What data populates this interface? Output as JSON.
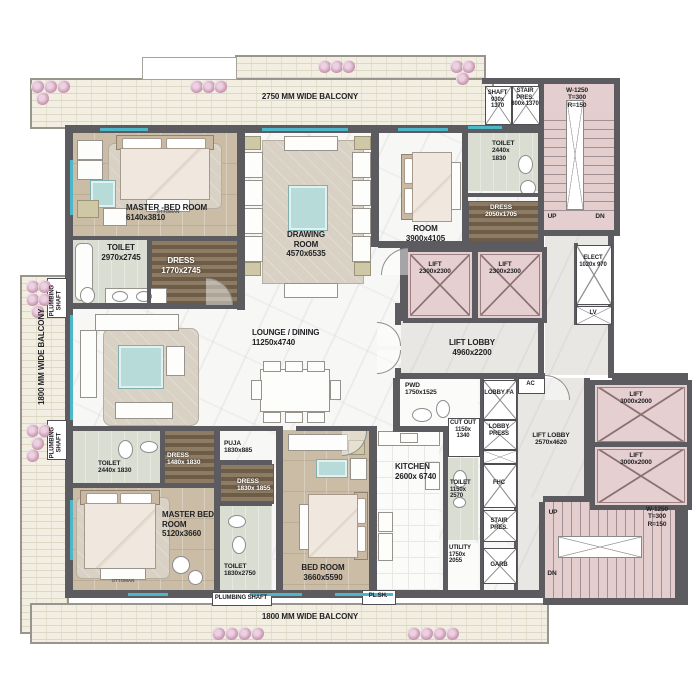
{
  "balcony": {
    "top": "2750 MM WIDE BALCONY",
    "left": "1800 MM WIDE BALCONY",
    "bottom": "1800 MM WIDE BALCONY"
  },
  "rooms": {
    "master_bed_1": {
      "name": "MASTER -BED ROOM",
      "dims": "6140x3810"
    },
    "toilet_1": {
      "name": "TOILET",
      "dims": "2970x2745"
    },
    "dress_1": {
      "name": "DRESS",
      "dims": "1770x2745"
    },
    "drawing": {
      "name": "DRAWING ROOM",
      "dims": "4570x6535"
    },
    "room": {
      "name": "ROOM",
      "dims": "3900x4105"
    },
    "toilet_2": {
      "name": "TOILET",
      "dims": "2440x 1830"
    },
    "dress_2": {
      "name": "DRESS",
      "dims": "2050x1705"
    },
    "lounge": {
      "name": "LOUNGE / DINING",
      "dims": "11250x4740"
    },
    "lift_lobby_1": {
      "name": "LIFT LOBBY",
      "dims": "4960x2200"
    },
    "lift_lobby_2": {
      "name": "LIFT LOBBY",
      "dims": "2570x4620"
    },
    "pwd": {
      "name": "PWD",
      "dims": "1750x1525"
    },
    "cut_out": {
      "name": "CUT OUT",
      "dims": "1150x 1340"
    },
    "toilet_5": {
      "name": "TOILET",
      "dims": "1150x 2570"
    },
    "utility": {
      "name": "UTILITY",
      "dims": "1750x 2055"
    },
    "kitchen": {
      "name": "KITCHEN",
      "dims": "2600x 6740"
    },
    "bed_room": {
      "name": "BED ROOM",
      "dims": "3660x5590"
    },
    "master_bed_2": {
      "name": "MASTER BED ROOM",
      "dims": "5120x3660"
    },
    "toilet_3": {
      "name": "TOILET",
      "dims": "2440x 1830"
    },
    "dress_3": {
      "name": "DRESS",
      "dims": "1480x 1830"
    },
    "puja": {
      "name": "PUJA",
      "dims": "1830x885"
    },
    "dress_4": {
      "name": "DRESS",
      "dims": "1830x 1855"
    },
    "toilet_4": {
      "name": "TOILET",
      "dims": "1830x2750"
    }
  },
  "service": {
    "shaft": {
      "name": "SHAFT",
      "dims": "930x 1370"
    },
    "stair_pres_1": {
      "name": "STAIR PRES.",
      "dims": "800x 1370"
    },
    "elect": {
      "name": "ELECT",
      "dims": "1020x 970"
    },
    "lv": "LV",
    "ac": "AC",
    "lobby_fa": "LOBBY FA",
    "lobby_press": "LOBBY PRESS",
    "fhc": "FHC",
    "stair_pres_2": "STAIR PRES.",
    "garb": "GARB",
    "plumbing_shaft": "PLUMBING SHAFT",
    "pl_sh": "PL.SH."
  },
  "stairs": {
    "code": "W-1250",
    "tread": "T=300",
    "riser": "R=150",
    "up": "UP",
    "dn": "DN"
  },
  "lifts": {
    "small": {
      "name": "LIFT",
      "dims": "2300x2300"
    },
    "large": {
      "name": "LIFT",
      "dims": "3000x2000"
    }
  },
  "furniture": {
    "ottoman": "OTTOMAN"
  },
  "colors": {
    "wall": "#5c5b5f",
    "balcony": "#f2efe2",
    "wood": "#cbbca5",
    "marble": "#f7f7f5",
    "core_pink": "#e4cecf",
    "window_teal": "#4db6c9",
    "bath": "#d9ddd2",
    "flower": "#c897b2"
  }
}
